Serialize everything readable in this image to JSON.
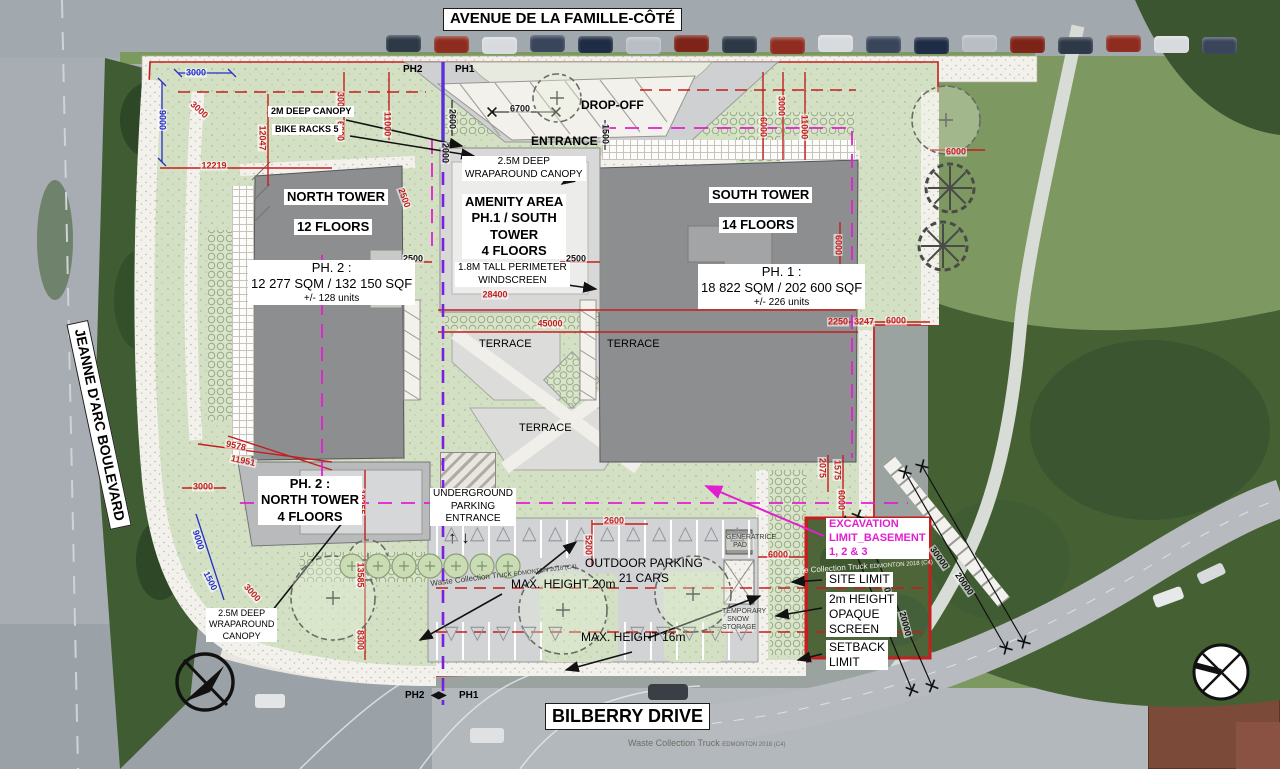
{
  "roads": {
    "top": "AVENUE DE LA FAMILLE-CÔTÉ",
    "left": "JEANNE D'ARC BOULEVARD",
    "bottom": "BILBERRY DRIVE"
  },
  "phase": {
    "ph2": "PH2",
    "ph1": "PH1",
    "arrows": "◀▶"
  },
  "towers": {
    "north": {
      "l1": "NORTH TOWER",
      "l2": "12 FLOORS"
    },
    "south": {
      "l1": "SOUTH TOWER",
      "l2": "14 FLOORS"
    },
    "amenity": {
      "l1": "AMENITY AREA",
      "l2": "PH.1 / SOUTH",
      "l3": "TOWER",
      "l4": "4 FLOORS"
    },
    "ph2_block": {
      "l1": "PH. 2 :",
      "l2": "NORTH TOWER",
      "l3": "4 FLOORS"
    },
    "ph2_stats": {
      "l1": "PH. 2 :",
      "l2": "12 277 SQM / 132 150 SQF",
      "l3": "+/- 128 units"
    },
    "ph1_stats": {
      "l1": "PH. 1 :",
      "l2": "18 822 SQM / 202 600 SQF",
      "l3": "+/- 226 units"
    }
  },
  "labels": {
    "drop_off": "DROP-OFF",
    "entrance": "ENTRANCE",
    "canopy_top_1": "2.5M DEEP",
    "canopy_top_2": "WRAPAROUND CANOPY",
    "canopy_2m": "2M DEEP CANOPY",
    "bike_racks": "BIKE RACKS 5",
    "windscreen_1": "1.8M TALL PERIMETER",
    "windscreen_2": "WINDSCREEN",
    "terrace": "TERRACE",
    "underground_1": "UNDERGROUND",
    "underground_2": "PARKING",
    "underground_3": "ENTRANCE",
    "outdoor_1": "OUTDOOR PARKING",
    "outdoor_2": "21 CARS",
    "max_h20": "MAX. HEIGHT 20m",
    "max_h16": "MAX. HEIGHT 16m",
    "canopy_bl_1": "2.5M DEEP",
    "canopy_bl_2": "WRAPAROUND",
    "canopy_bl_3": "CANOPY",
    "excavation_1": "EXCAVATION",
    "excavation_2": "LIMIT_BASEMENT",
    "excavation_3": "1, 2 & 3",
    "site_limit": "SITE LIMIT",
    "opaque_1": "2m HEIGHT",
    "opaque_2": "OPAQUE",
    "opaque_3": "SCREEN",
    "setback_1": "SETBACK",
    "setback_2": "LIMIT",
    "generatrice_1": "GENERATRICE",
    "generatrice_2": "PAD",
    "temp_snow_1": "TEMPORARY",
    "temp_snow_2": "SNOW",
    "temp_snow_3": "STORAGE",
    "waste_truck": "Waste Collection Truck",
    "waste_truck_sub": "EDMONTON 2018 (C4)"
  },
  "colors": {
    "site_limit_red": "#c41e1e",
    "excavation_magenta": "#e21fd0",
    "phase_purple": "#7a1fe0",
    "dim_blue": "#2430c8",
    "landscape_green": "#d3e0c4",
    "tower_gray": "#8d8e90",
    "car_palette": [
      "#2e3947",
      "#8e2d1f",
      "#d8dbde",
      "#39455a",
      "#1f2c45",
      "#b9bec4",
      "#7d2318"
    ]
  },
  "dimensions": [
    {
      "t": "3000",
      "x": 196,
      "y": 73,
      "r": 0,
      "c": "b"
    },
    {
      "t": "9000",
      "x": 162,
      "y": 120,
      "r": 90,
      "c": "b"
    },
    {
      "t": "3000",
      "x": 199,
      "y": 110,
      "r": 42,
      "c": "r"
    },
    {
      "t": "12047",
      "x": 262,
      "y": 138,
      "r": 90,
      "c": "r"
    },
    {
      "t": "12219",
      "x": 214,
      "y": 166,
      "r": 0,
      "c": "r"
    },
    {
      "t": "3000",
      "x": 340,
      "y": 102,
      "r": 90,
      "c": "r"
    },
    {
      "t": "6000",
      "x": 340,
      "y": 131,
      "r": 90,
      "c": "r"
    },
    {
      "t": "11000",
      "x": 387,
      "y": 124,
      "r": 90,
      "c": "r"
    },
    {
      "t": "2600",
      "x": 452,
      "y": 119,
      "r": 90,
      "c": "k"
    },
    {
      "t": "6700",
      "x": 520,
      "y": 109,
      "r": 0,
      "c": "k"
    },
    {
      "t": "1500",
      "x": 605,
      "y": 134,
      "r": 90,
      "c": "k"
    },
    {
      "t": "2000",
      "x": 445,
      "y": 153,
      "r": 90,
      "c": "k"
    },
    {
      "t": "3000",
      "x": 781,
      "y": 106,
      "r": 90,
      "c": "r"
    },
    {
      "t": "6000",
      "x": 763,
      "y": 127,
      "r": 90,
      "c": "r"
    },
    {
      "t": "11000",
      "x": 804,
      "y": 127,
      "r": 90,
      "c": "r"
    },
    {
      "t": "2500",
      "x": 404,
      "y": 198,
      "r": 70,
      "c": "r"
    },
    {
      "t": "2500",
      "x": 413,
      "y": 259,
      "r": 0,
      "c": "k"
    },
    {
      "t": "2500",
      "x": 576,
      "y": 259,
      "r": 0,
      "c": "k"
    },
    {
      "t": "28400",
      "x": 495,
      "y": 295,
      "r": 0,
      "c": "r"
    },
    {
      "t": "45000",
      "x": 550,
      "y": 324,
      "r": 0,
      "c": "r"
    },
    {
      "t": "9578",
      "x": 236,
      "y": 446,
      "r": 12,
      "c": "r"
    },
    {
      "t": "11951",
      "x": 243,
      "y": 461,
      "r": 12,
      "c": "r"
    },
    {
      "t": "3000",
      "x": 203,
      "y": 487,
      "r": 0,
      "c": "r"
    },
    {
      "t": "9000",
      "x": 198,
      "y": 540,
      "r": 73,
      "c": "b"
    },
    {
      "t": "1500",
      "x": 210,
      "y": 581,
      "r": 63,
      "c": "b"
    },
    {
      "t": "3000",
      "x": 252,
      "y": 593,
      "r": 48,
      "c": "r"
    },
    {
      "t": "10255",
      "x": 361,
      "y": 502,
      "r": 90,
      "c": "r"
    },
    {
      "t": "13585",
      "x": 360,
      "y": 575,
      "r": 90,
      "c": "r"
    },
    {
      "t": "8300",
      "x": 360,
      "y": 640,
      "r": 90,
      "c": "r"
    },
    {
      "t": "2600",
      "x": 614,
      "y": 521,
      "r": 0,
      "c": "r"
    },
    {
      "t": "5200",
      "x": 588,
      "y": 545,
      "r": 90,
      "c": "r"
    },
    {
      "t": "6000",
      "x": 838,
      "y": 245,
      "r": 90,
      "c": "r"
    },
    {
      "t": "6000",
      "x": 956,
      "y": 152,
      "r": 0,
      "c": "r"
    },
    {
      "t": "2250",
      "x": 838,
      "y": 322,
      "r": 0,
      "c": "r"
    },
    {
      "t": "3247",
      "x": 864,
      "y": 322,
      "r": 0,
      "c": "r"
    },
    {
      "t": "6000",
      "x": 896,
      "y": 321,
      "r": 0,
      "c": "r"
    },
    {
      "t": "2075",
      "x": 822,
      "y": 468,
      "r": 90,
      "c": "r"
    },
    {
      "t": "1575",
      "x": 837,
      "y": 470,
      "r": 90,
      "c": "r"
    },
    {
      "t": "6000",
      "x": 841,
      "y": 500,
      "r": 90,
      "c": "r"
    },
    {
      "t": "6000",
      "x": 778,
      "y": 555,
      "r": 0,
      "c": "r"
    },
    {
      "t": "30000",
      "x": 887,
      "y": 590,
      "r": 75,
      "c": "k"
    },
    {
      "t": "20000",
      "x": 905,
      "y": 624,
      "r": 75,
      "c": "k"
    },
    {
      "t": "30000",
      "x": 939,
      "y": 558,
      "r": 55,
      "c": "k"
    },
    {
      "t": "20000",
      "x": 964,
      "y": 584,
      "r": 55,
      "c": "k"
    }
  ],
  "trees": {
    "gears": [
      [
        950,
        188
      ],
      [
        943,
        246
      ]
    ],
    "clouds": [
      [
        333,
        598,
        42
      ],
      [
        563,
        610,
        44
      ],
      [
        693,
        594,
        38
      ],
      [
        946,
        120,
        34
      ],
      [
        557,
        98,
        24
      ],
      [
        368,
        560,
        20
      ]
    ],
    "plus_row": {
      "y": 566,
      "x0": 352,
      "n": 7,
      "dx": 26
    }
  }
}
